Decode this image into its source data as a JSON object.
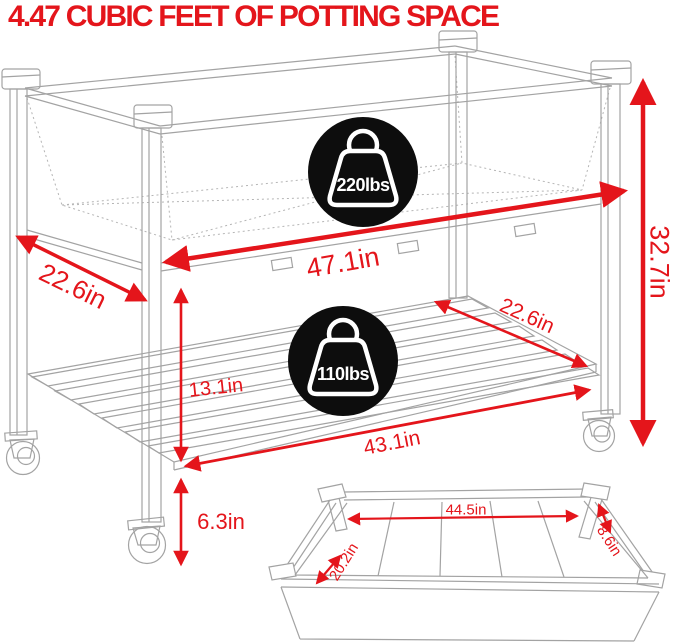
{
  "title": "4.47 CUBIC FEET OF POTTING SPACE",
  "colors": {
    "accent_red": "#e4151b",
    "badge_black": "#0d0d0d",
    "line_gray": "#a3a3a3",
    "badge_text_white": "#ffffff"
  },
  "badges": {
    "top": {
      "icon": "weight-icon",
      "label": "220lbs"
    },
    "bottom": {
      "icon": "weight-icon",
      "label": "110lbs"
    }
  },
  "dimensions": {
    "bed_depth": "22.6in",
    "bed_width": "47.1in",
    "overall_height": "32.7in",
    "shelf_depth": "22.6in",
    "bed_to_shelf": "13.1in",
    "shelf_width": "43.1in",
    "ground_clearance": "6.3in"
  },
  "inset": {
    "inner_length": "44.5in",
    "inner_width": "20.2in",
    "inner_depth": "8.6in"
  }
}
